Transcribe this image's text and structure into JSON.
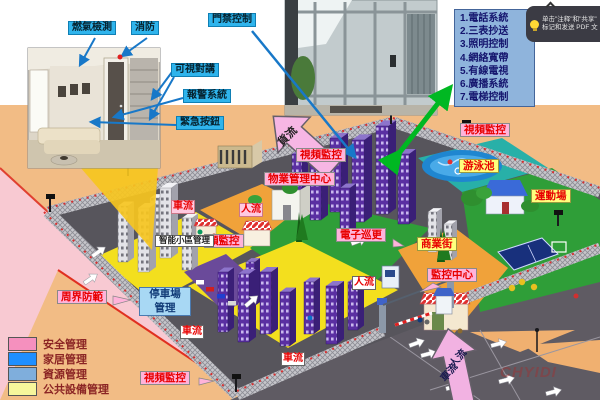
{
  "home_callouts": {
    "gas": "燃氣檢測",
    "fire": "消防",
    "access": "門禁控制",
    "intercom": "可視對講",
    "alarm": "報警系統",
    "emergency": "緊急按鈕"
  },
  "services": {
    "items": [
      "1.電話系統",
      "2.三表抄送",
      "3.照明控制",
      "4.網絡寬帶",
      "5.有線電視",
      "6.廣播系統",
      "7.電梯控制"
    ]
  },
  "pdf_tooltip": {
    "line1": "单击\"注释\"和\"共享\"",
    "line2": "标记和发送 PDF 文"
  },
  "map_labels": {
    "video_top_center": "視頻監控",
    "video_top_right": "視頻監控",
    "video_partial": "頻監控",
    "video_bottom": "視頻監控",
    "property_center": "物業管理中心",
    "smart_mgmt": "智能小區管理",
    "e_patrol": "電子巡更",
    "monitor_center": "監控中心",
    "perimeter": "周界防範",
    "parking_line1": "停車場",
    "parking_line2": "管理",
    "pool": "游泳池",
    "sports": "運動場",
    "street": "商業街"
  },
  "flow_labels": {
    "car_left": "車流",
    "people_left": "人流",
    "people_center": "人流",
    "car_parking": "車流",
    "car_center": "車流",
    "goods": "貨流",
    "entrance_people": "人流",
    "entrance_car": "車流"
  },
  "legend": {
    "items": [
      {
        "label": "安全管理",
        "color": "#F590BE"
      },
      {
        "label": "家居管理",
        "color": "#1E8FFF"
      },
      {
        "label": "資源管理",
        "color": "#7FAEDC"
      },
      {
        "label": "公共設備管理",
        "color": "#F6F69B"
      }
    ]
  },
  "watermark": "CHYIDI",
  "accent_colors": {
    "label_pink": "#FFB3DA",
    "label_yellow": "#FFFF7D",
    "label_cyan": "#2FB4EC",
    "arrow_green": "#00B822",
    "text_red": "#E80000"
  }
}
